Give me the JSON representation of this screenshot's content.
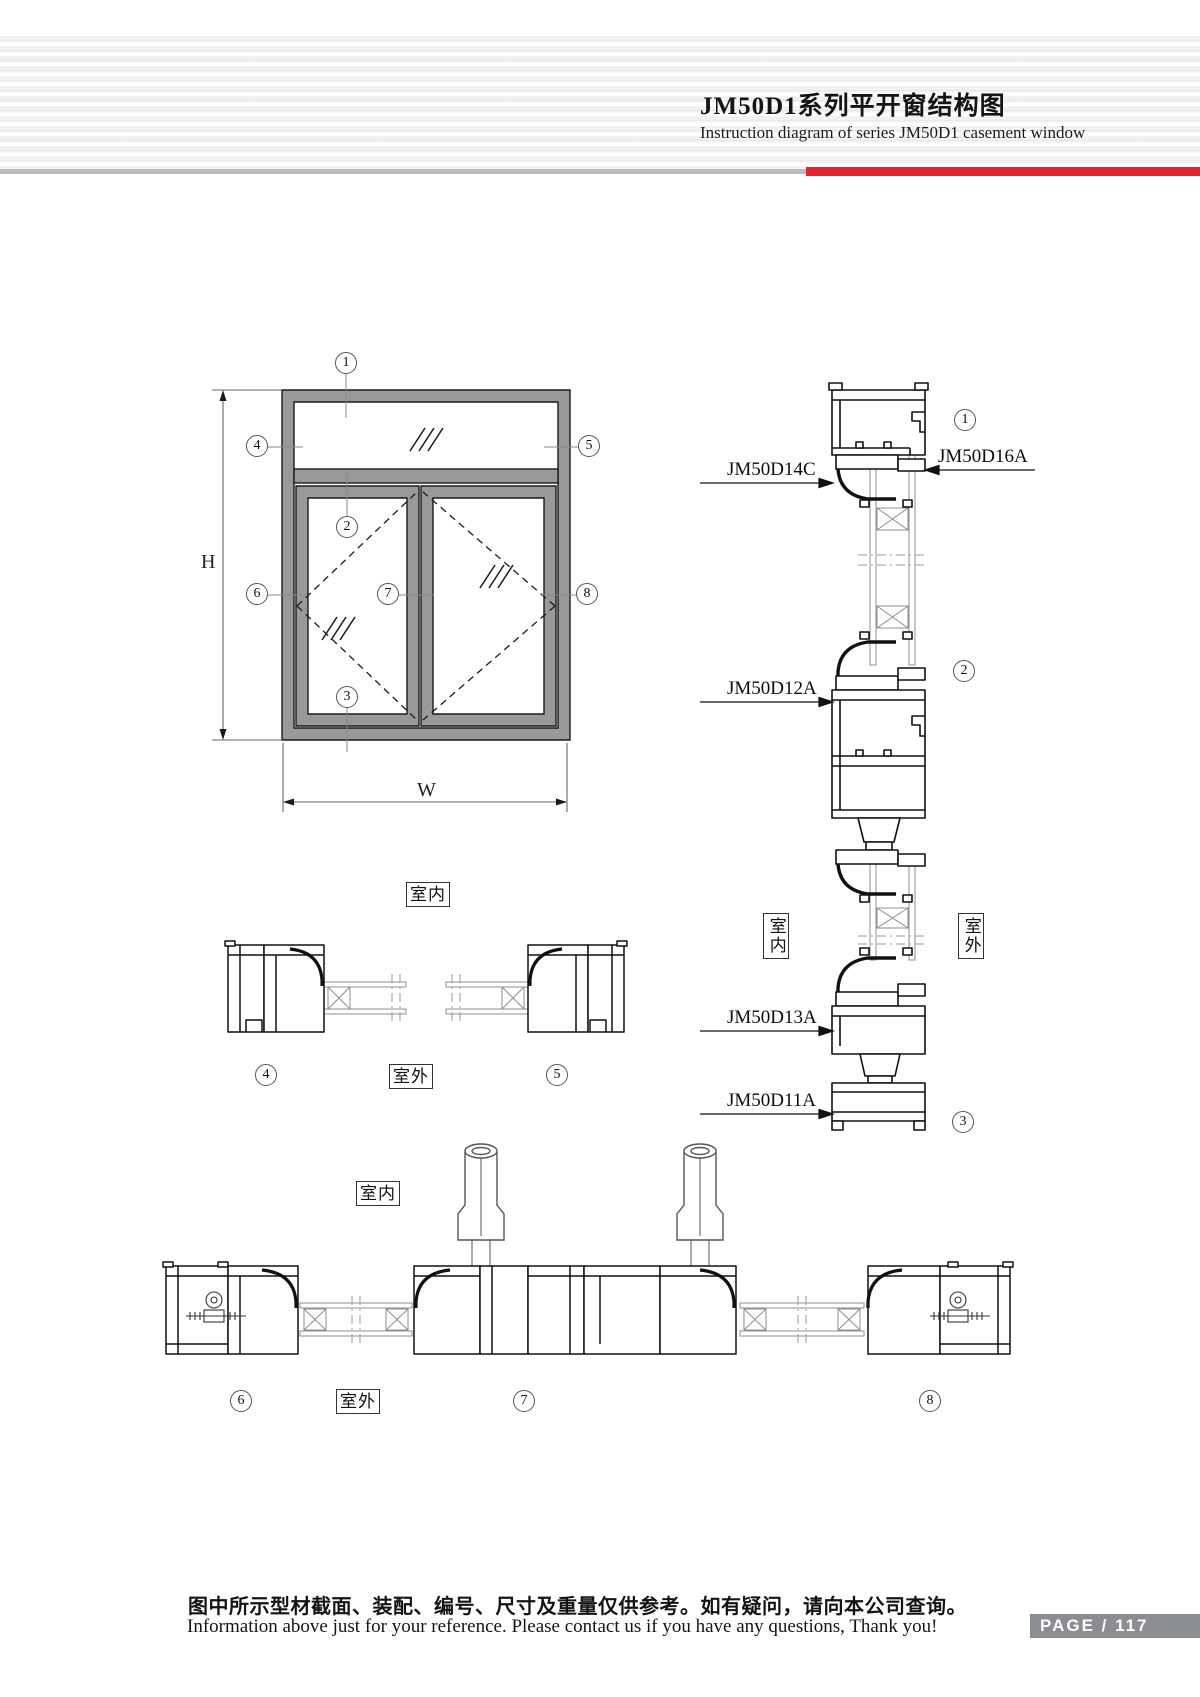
{
  "header": {
    "title_zh": "JM50D1系列平开窗结构图",
    "title_en": "Instruction diagram of series JM50D1 casement window"
  },
  "colors": {
    "accent_red": "#e8232b",
    "header_bar_gray": "#b9bbbd",
    "frame_fill": "#97999b",
    "badge_bg": "#8b8e90"
  },
  "elevation": {
    "dim_h": "H",
    "dim_w": "W",
    "callouts": [
      {
        "num": "1"
      },
      {
        "num": "2"
      },
      {
        "num": "3"
      },
      {
        "num": "4"
      },
      {
        "num": "5"
      },
      {
        "num": "6"
      },
      {
        "num": "7"
      },
      {
        "num": "8"
      }
    ]
  },
  "vertical_section": {
    "indoor": "室内",
    "outdoor": "室外",
    "parts": [
      {
        "code": "JM50D14C"
      },
      {
        "code": "JM50D16A"
      },
      {
        "code": "JM50D12A"
      },
      {
        "code": "JM50D13A"
      },
      {
        "code": "JM50D11A"
      }
    ],
    "callouts": [
      {
        "num": "1"
      },
      {
        "num": "2"
      },
      {
        "num": "3"
      }
    ]
  },
  "jamb": {
    "indoor": "室内",
    "outdoor": "室外",
    "callouts": [
      {
        "num": "4"
      },
      {
        "num": "5"
      }
    ]
  },
  "bottom": {
    "indoor": "室内",
    "outdoor": "室外",
    "callouts": [
      {
        "num": "6"
      },
      {
        "num": "7"
      },
      {
        "num": "8"
      }
    ]
  },
  "footer": {
    "note_zh": "图中所示型材截面、装配、编号、尺寸及重量仅供参考。如有疑问，请向本公司查询。",
    "note_en": "Information above just for your reference. Please contact us if you have any questions, Thank you!",
    "page_text": "PAGE / 117"
  }
}
